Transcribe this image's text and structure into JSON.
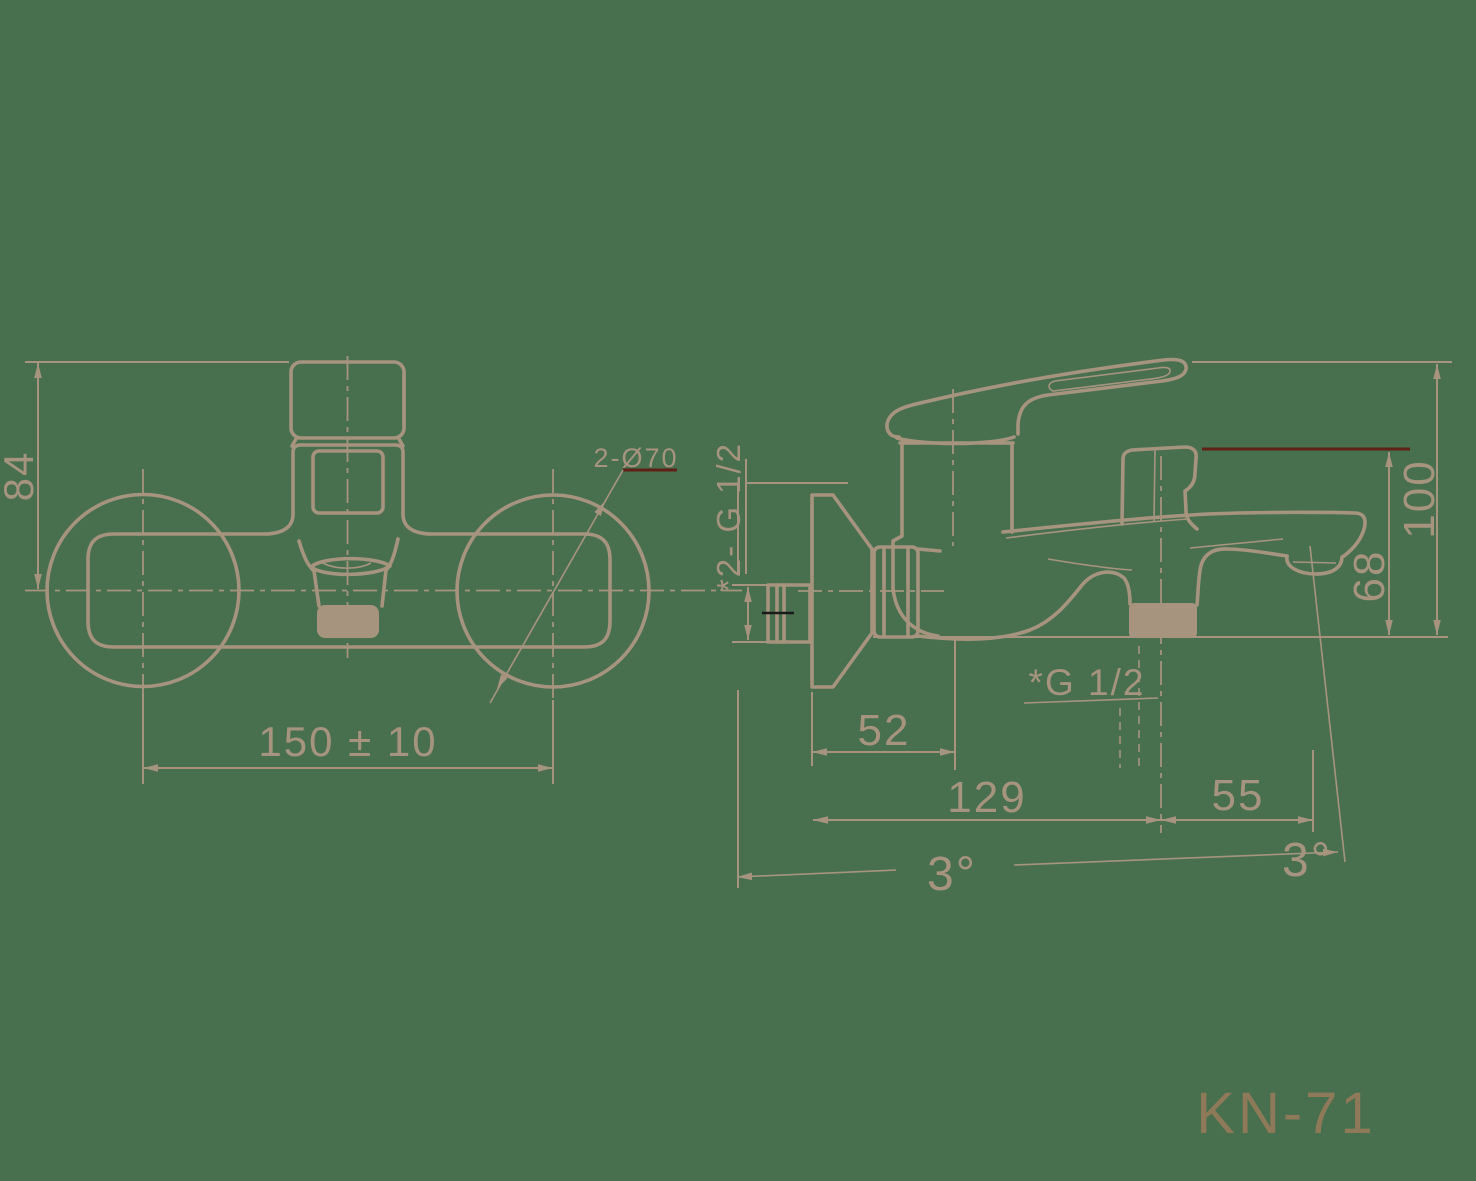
{
  "model_label": "KN-71",
  "colors": {
    "background": "#48704F",
    "line": "#A6947F",
    "accent_red": "#5F2116",
    "black_centerline": "#1B1B1B",
    "model_text": "#8E7958"
  },
  "front_view": {
    "name": "front-view",
    "dim_height": "84",
    "dim_center_distance": "150 ± 10",
    "dim_flange_diameter": "2-Ø70"
  },
  "side_view": {
    "name": "side-view",
    "dim_inlet_thread": "*2- G 1/2",
    "dim_wall_offset": "52",
    "dim_reach": "129",
    "dim_outlet_offset": "55",
    "dim_total_height": "100",
    "dim_spout_height": "68",
    "dim_shower_thread": "*G 1/2",
    "dim_angle_left": "3°",
    "dim_angle_right": "3°"
  }
}
